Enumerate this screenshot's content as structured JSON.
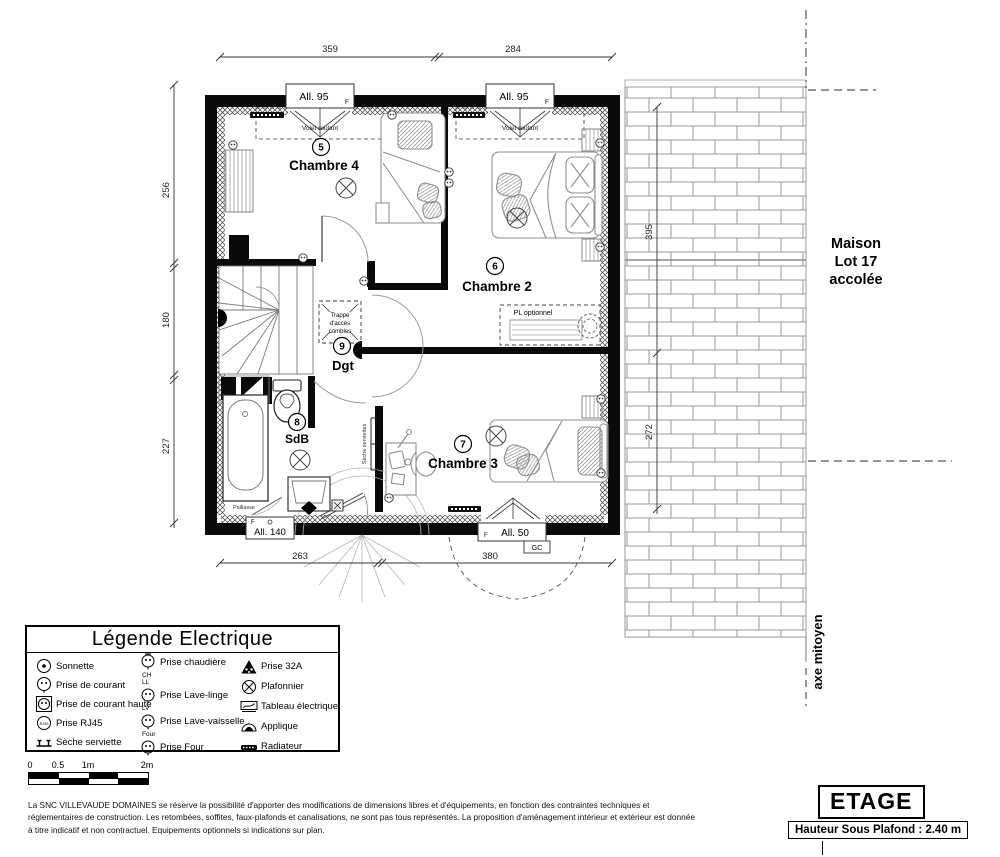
{
  "plan": {
    "rooms": [
      {
        "num": "5",
        "name": "Chambre 4"
      },
      {
        "num": "6",
        "name": "Chambre 2"
      },
      {
        "num": "7",
        "name": "Chambre 3"
      },
      {
        "num": "8",
        "name": "SdB"
      },
      {
        "num": "9",
        "name": "Dgt"
      }
    ],
    "windows": {
      "allege95": "All. 95",
      "allege140": "All. 140",
      "allege50": "All. 50",
      "f": "F",
      "gc": "GC",
      "volet_roulant": "Volet roulant"
    },
    "labels": {
      "trappe_l1": "Trappe",
      "trappe_l2": "d'accès",
      "trappe_l3": "combles",
      "pl_optionnel": "PL optionnel",
      "paillasse": "Paillasse",
      "seche_serviettes": "Sèche serviettes"
    },
    "dims": {
      "top": [
        "359",
        "284"
      ],
      "left": [
        "256",
        "180",
        "227"
      ],
      "bottom": [
        "263",
        "380"
      ],
      "right": [
        "395",
        "272"
      ]
    },
    "neighbor": {
      "l1": "Maison",
      "l2": "Lot 17",
      "l3": "accolée"
    },
    "axis": "axe mitoyen"
  },
  "legend": {
    "title": "Légende Electrique",
    "col1": [
      {
        "label": "Sonnette"
      },
      {
        "label": "Prise de courant"
      },
      {
        "label": "Prise de courant haute"
      },
      {
        "label": "Prise RJ45",
        "icon_text": "RJ45"
      },
      {
        "label": "Sèche serviette"
      }
    ],
    "col2": [
      {
        "tag": "CH",
        "label": "Prise chaudière"
      },
      {
        "tag": "LL",
        "label": "Prise Lave-linge"
      },
      {
        "tag": "LV",
        "label": "Prise Lave-vaisselle"
      },
      {
        "tag": "Four",
        "label": "Prise Four"
      }
    ],
    "col3": [
      {
        "label": "Prise 32A"
      },
      {
        "label": "Plafonnier"
      },
      {
        "label": "Tableau électrique"
      },
      {
        "label": "Applique"
      },
      {
        "label": "Radiateur"
      }
    ]
  },
  "scalebar": {
    "labels": [
      "0",
      "0.5",
      "1m",
      "2m"
    ]
  },
  "footer": {
    "disclaimer": "La SNC VILLEVAUDE DOMAINES se réserve la possibilité d'apporter des modifications de dimensions libres et d'équipements, en fonction des contraintes techniques et réglementaires de construction. Les retombées, soffites, faux-plafonds et canalisations, ne sont pas tous représentés. La proposition d'aménagement intérieur et extérieur est donnée à titre indicatif et non contractuel. Equipements optionnels si indications sur plan.",
    "stage": "ETAGE",
    "ceiling": "Hauteur Sous Plafond : 2.40 m"
  },
  "colors": {
    "wall": "#000000",
    "furniture": "#8f8f8f",
    "brick": "#a0a0a0"
  }
}
